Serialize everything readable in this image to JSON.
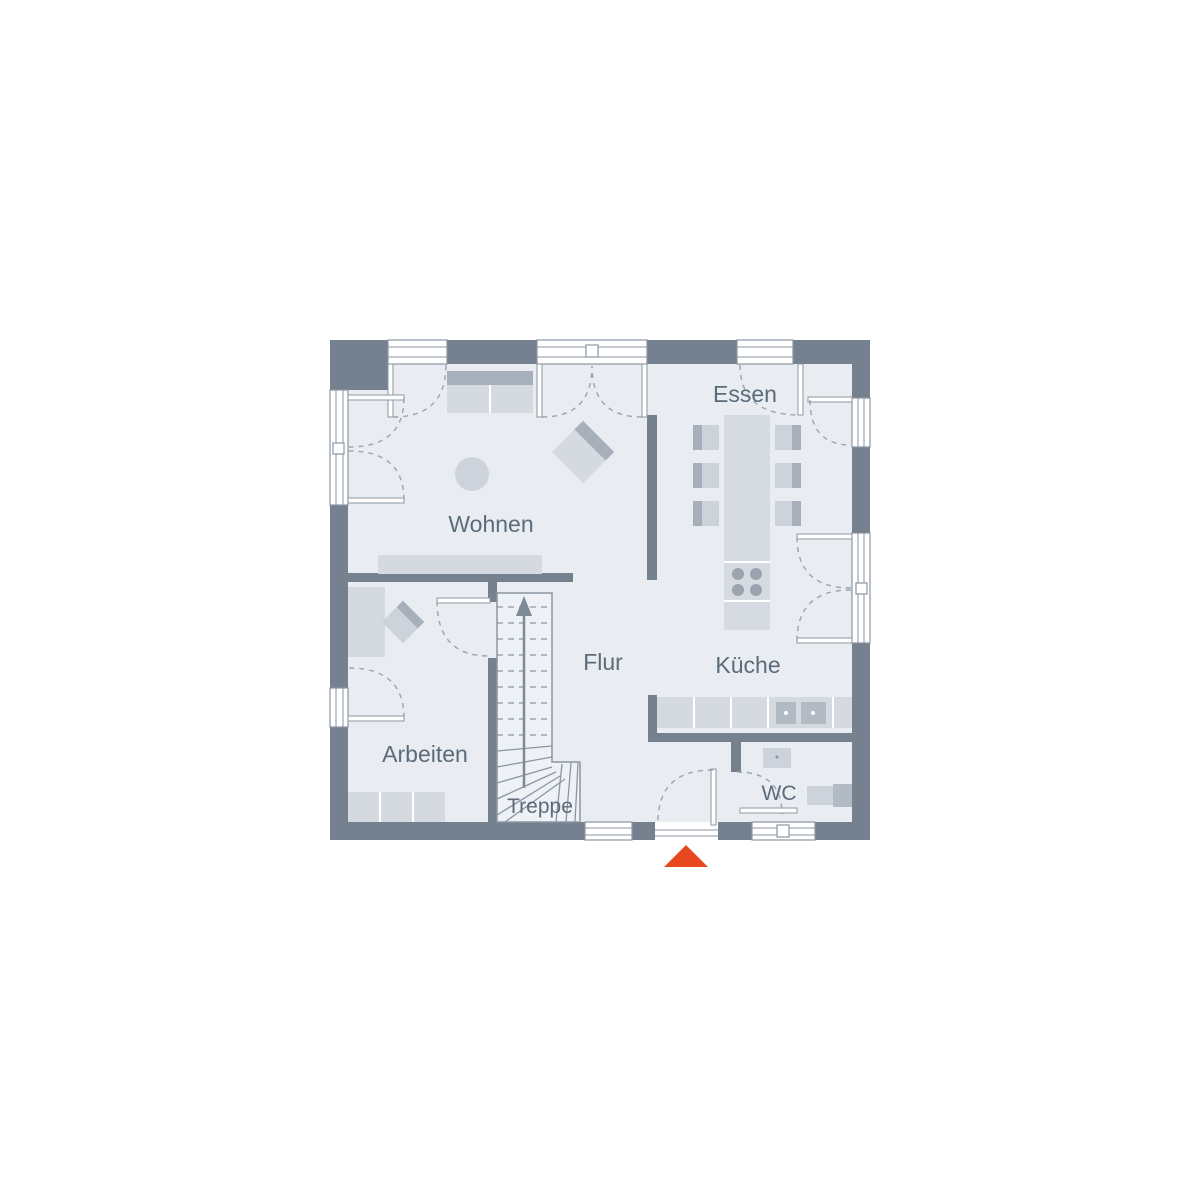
{
  "floorplan": {
    "rooms": {
      "wohnen": "Wohnen",
      "essen": "Essen",
      "kueche": "Küche",
      "flur": "Flur",
      "arbeiten": "Arbeiten",
      "treppe": "Treppe",
      "wc": "WC"
    },
    "entrance": {
      "marker": "entrance-triangle",
      "color": "#e8481f"
    },
    "colors": {
      "background": "#ffffff",
      "wall": "#75818f",
      "floor": "#e9edf1",
      "furniture": "#d4dae0",
      "furniture_mid": "#ccd3da",
      "furniture_accent": "#a7b0ba",
      "fixture_dark": "#b2bac4",
      "stair_fill": "#eef1f5",
      "line": "#8b96a2",
      "dashed_arc": "#9aa4af",
      "label_text": "#5c6b7a"
    }
  }
}
